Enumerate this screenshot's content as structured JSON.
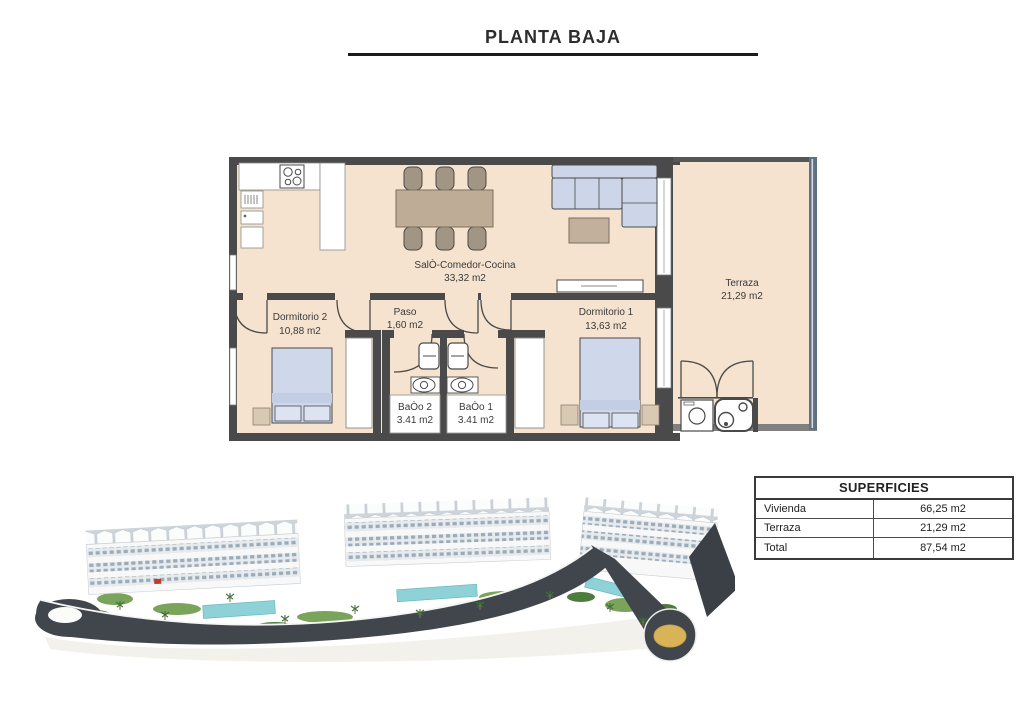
{
  "header": {
    "title": "PLANTA BAJA"
  },
  "floor_plan": {
    "rooms": {
      "salon": {
        "name": "SalÒ-Comedor-Cocina",
        "area": "33,32 m2"
      },
      "terraza": {
        "name": "Terraza",
        "area": "21,29 m2"
      },
      "dormitorio2": {
        "name": "Dormitorio 2",
        "area": "10,88 m2"
      },
      "paso": {
        "name": "Paso",
        "area": "1,60 m2"
      },
      "dormitorio1": {
        "name": "Dormitorio 1",
        "area": "13,63 m2"
      },
      "bano2": {
        "name": "BaÒo 2",
        "area": "3.41 m2"
      },
      "bano1": {
        "name": "BaÒo 1",
        "area": "3.41 m2"
      }
    },
    "colors": {
      "floor": "#f5e3cf",
      "wall": "#4a4a4a",
      "upholstery": "#cdd6e8",
      "wood": "#bfac96",
      "railing": "#5f7181"
    }
  },
  "superficies": {
    "header": "SUPERFICIES",
    "rows": [
      {
        "label": "Vivienda",
        "value": "66,25 m2"
      },
      {
        "label": "Terraza",
        "value": "21,29 m2"
      },
      {
        "label": "Total",
        "value": "87,54 m2"
      }
    ]
  },
  "aerial_render": {
    "colors": {
      "road": "#41464c",
      "roundabout": "#d9b357",
      "pool": "#8ed2d8",
      "greenery": "#6f9c55",
      "building": "#f7f8f7"
    }
  }
}
